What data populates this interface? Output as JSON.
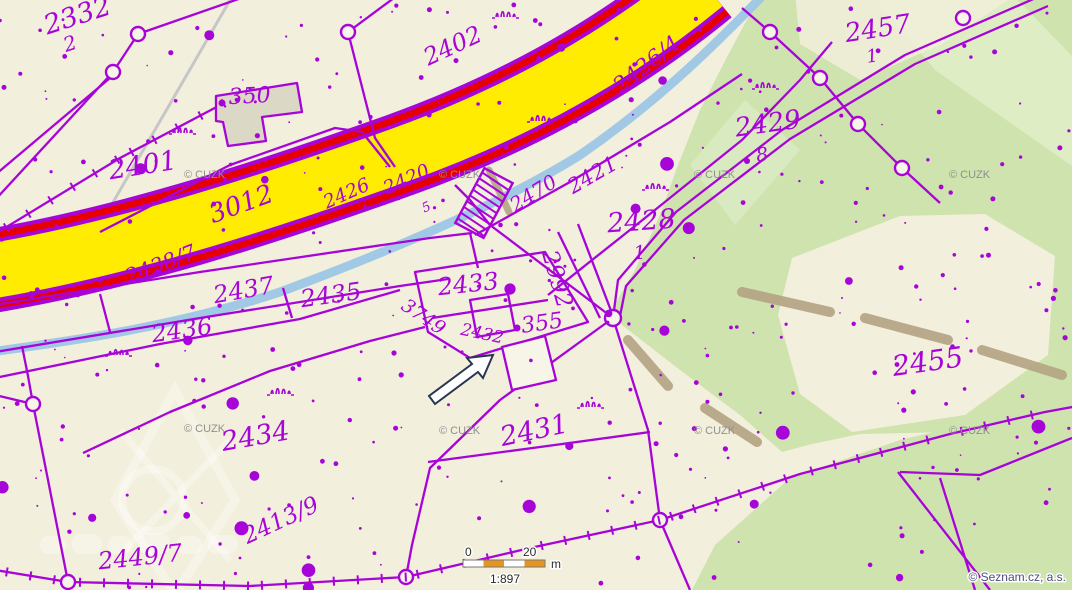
{
  "attribution": {
    "cuzk": "© CUZK",
    "seznam": "© Seznam.cz, a.s."
  },
  "scale_bar": {
    "start_label": "0",
    "end_label": "20",
    "unit": "m",
    "scale_ratio": "1:897"
  },
  "road": {
    "number": "3012"
  },
  "parcels": [
    {
      "text": "2332"
    },
    {
      "text": "2"
    },
    {
      "text": "2402"
    },
    {
      "text": "350"
    },
    {
      "text": "2401"
    },
    {
      "text": "2438/7"
    },
    {
      "text": "2426"
    },
    {
      "text": "2420"
    },
    {
      "text": "5"
    },
    {
      "text": "2426/4"
    },
    {
      "text": "2470"
    },
    {
      "text": "2421"
    },
    {
      "text": "2428"
    },
    {
      "text": "1"
    },
    {
      "text": "2429"
    },
    {
      "text": "8"
    },
    {
      "text": "2457"
    },
    {
      "text": "1"
    },
    {
      "text": "2992"
    },
    {
      "text": "2433"
    },
    {
      "text": "2437"
    },
    {
      "text": "2435"
    },
    {
      "text": "2436"
    },
    {
      "text": "3749"
    },
    {
      "text": "2432"
    },
    {
      "text": "355"
    },
    {
      "text": "2434"
    },
    {
      "text": "2431"
    },
    {
      "text": "2455"
    },
    {
      "text": "2449/7"
    },
    {
      "text": "2413/9"
    }
  ],
  "icons": {
    "highlight_arrow": "northeast-arrow",
    "bridge": "hatched-bridge-symbol",
    "survey_point": "boundary-circle-marker"
  },
  "colors": {
    "background": "#f2efdc",
    "parcel_line": "#a704d8",
    "road_fill": "#ffec00",
    "road_edge": "#e60000",
    "stream": "#9cc6e6",
    "green_area": "#cfe3ae",
    "green_light": "#e0edc6",
    "path_tan": "#b3a383",
    "scale_orange": "#e8951d"
  }
}
